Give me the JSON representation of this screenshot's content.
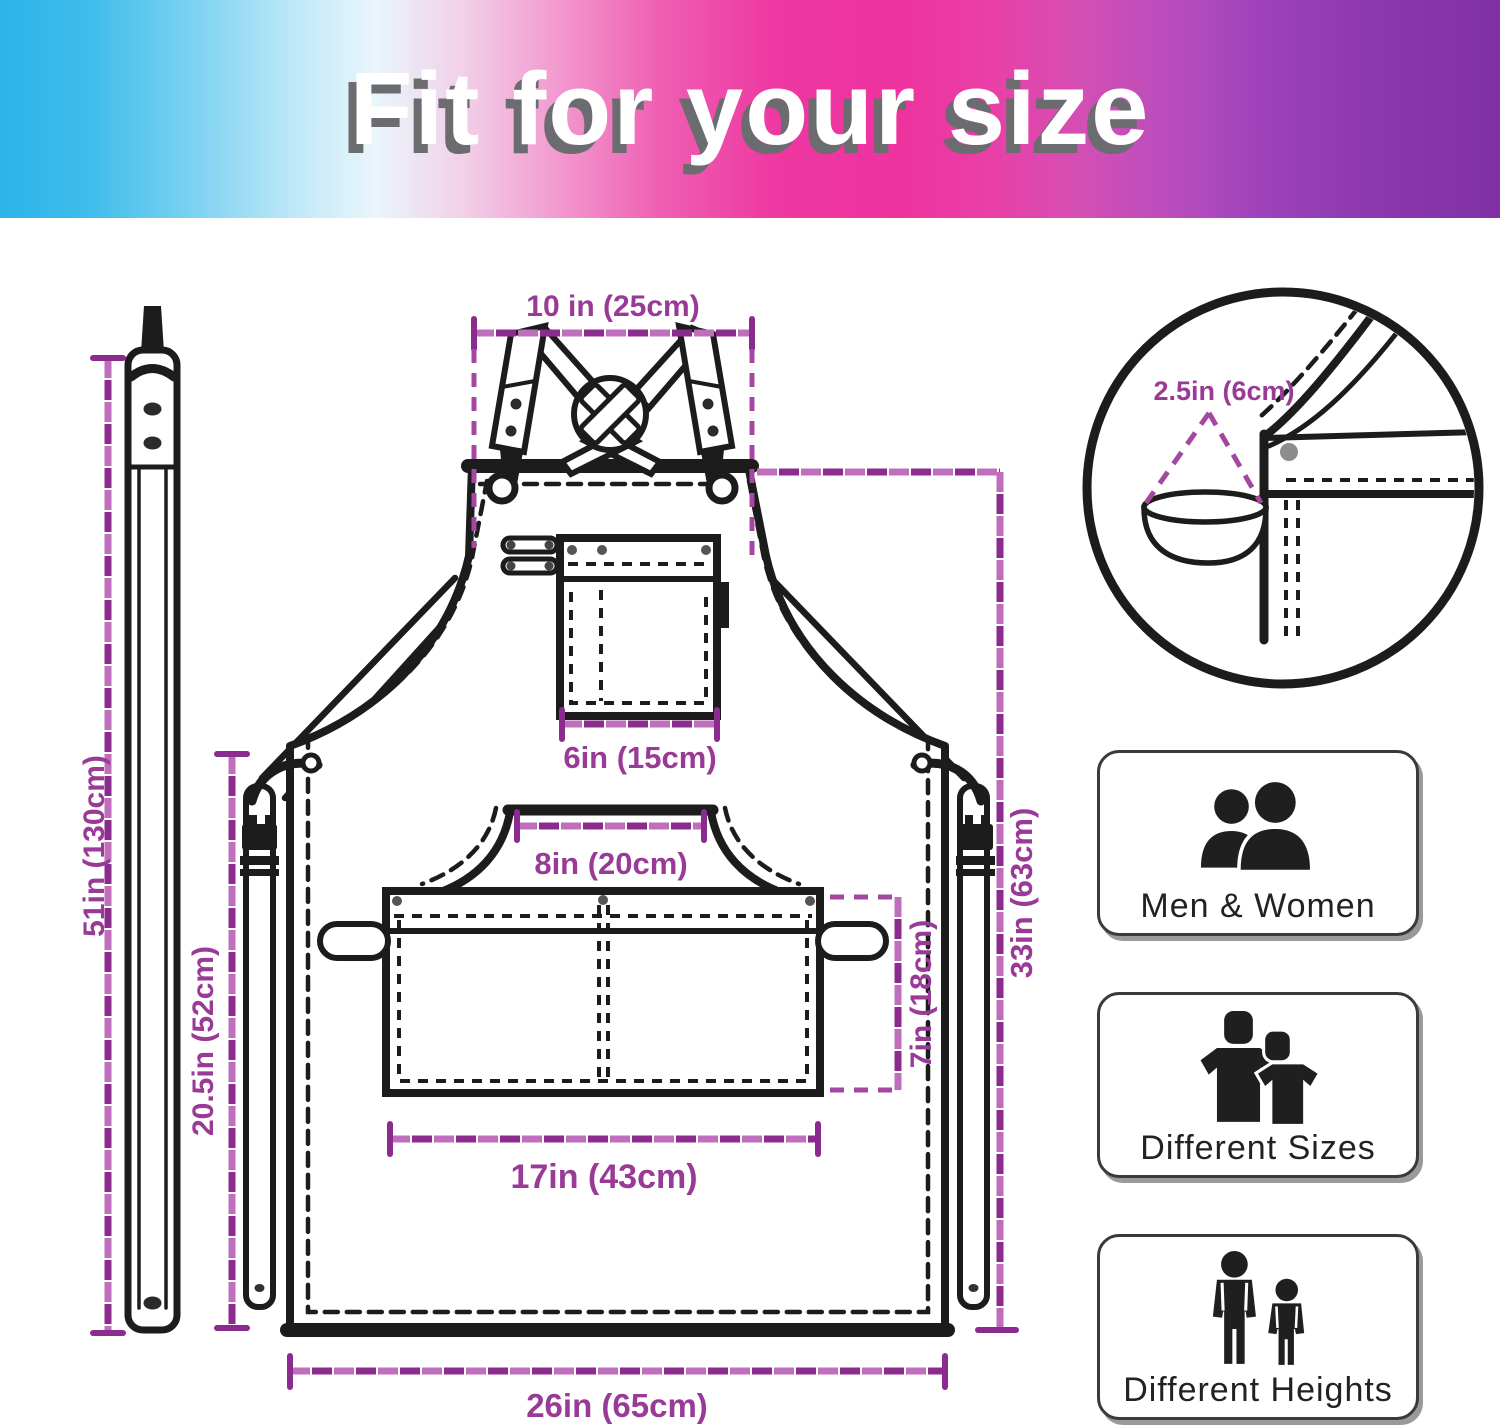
{
  "header": {
    "title": "Fit for your size"
  },
  "diagram": {
    "dimensions": {
      "neck_strap_width": "10 in (25cm)",
      "cross_strap_length": "51in (130cm)",
      "side_height": "20.5in (52cm)",
      "chest_pocket_width": "6in (15cm)",
      "waist_pocket_opening": "8in (20cm)",
      "waist_pocket_width": "17in (43cm)",
      "waist_pocket_height": "7in (18cm)",
      "apron_height": "33in (63cm)",
      "bottom_width": "26in (65cm)",
      "towel_loop": "2.5in (6cm)"
    }
  },
  "features": [
    {
      "label": "Men & Women",
      "icon": "men-women-icon"
    },
    {
      "label": "Different Sizes",
      "icon": "different-sizes-icon"
    },
    {
      "label": "Different Heights",
      "icon": "different-heights-icon"
    }
  ],
  "colors": {
    "dimension_dark": "#8c2b8e",
    "dimension_light": "#c06ebc",
    "dimension_text": "#993a96",
    "line_art": "#1c1c1c",
    "gradient_left": "#2cb4e9",
    "gradient_mid": "#ee339f",
    "gradient_right": "#8030a5"
  }
}
